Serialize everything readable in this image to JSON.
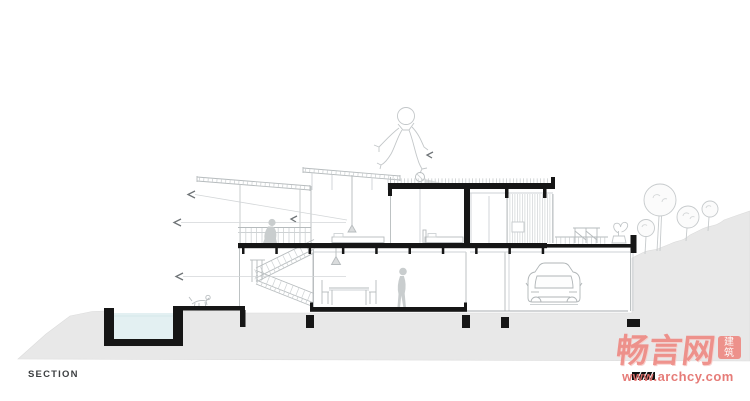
{
  "section": {
    "label": "SECTION"
  },
  "watermark": {
    "logo_text": "畅言网",
    "seal_char_top": "建",
    "seal_char_bottom": "筑",
    "url": "www.archcy.com"
  },
  "colors": {
    "cut_black": "#161616",
    "drawing_line": "#b6bbbd",
    "drawing_line_faint": "#ced2d4",
    "ground_fill": "#e8e8e8",
    "pool_water": "#e3f0f2",
    "figure_fill": "#c9cdce",
    "watermark_pink": "#ee8a84",
    "watermark_url_red": "#e4716d"
  },
  "drawing": {
    "type": "architectural-section-drawing",
    "elements": [
      "flat-roof",
      "green-roof-grass",
      "canopy-roof-left",
      "canopy-roof-center",
      "clerestory-glazing",
      "cut-wall",
      "upper-floor-slab",
      "ground-floor-slab",
      "terrace-slab",
      "foundation-footings",
      "swimming-pool",
      "pool-water",
      "switchback-staircase",
      "deck-railing",
      "dining-table-and-chairs",
      "pendant-lamps",
      "standing-person",
      "seated-person",
      "sketch-figure-on-roof",
      "bed",
      "daybed",
      "wood-siding-wall",
      "window",
      "car-in-garage",
      "terrace-pergola",
      "potted-plant",
      "trees-on-hill",
      "hillside",
      "dog-sketch",
      "breeze-arrows",
      "hatched-scale-bar"
    ]
  }
}
